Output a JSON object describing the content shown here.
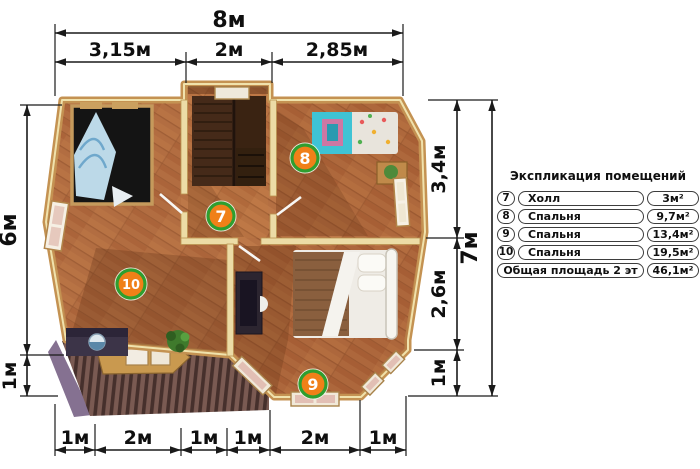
{
  "dims": {
    "top_total": "8м",
    "top_segments": [
      "3,15м",
      "2м",
      "2,85м"
    ],
    "left_segments": [
      "6м",
      "1м"
    ],
    "right_segments": [
      "3,4м",
      "2,6м",
      "1м"
    ],
    "right_total": "7м",
    "bottom_segments": [
      "1м",
      "2м",
      "1м",
      "1м",
      "2м",
      "1м"
    ]
  },
  "rooms": [
    {
      "num": "7",
      "name": "Холл",
      "area": "3м²"
    },
    {
      "num": "8",
      "name": "Спальня",
      "area": "9,7м²"
    },
    {
      "num": "9",
      "name": "Спальня",
      "area": "13,4м²"
    },
    {
      "num": "10",
      "name": "Спальня",
      "area": "19,5м²"
    }
  ],
  "legend": {
    "title": "Экспликация помещений",
    "total": {
      "name": "Общая площадь 2 эт",
      "area": "46,1м²"
    }
  },
  "colors": {
    "badge-fill": "#f08018",
    "badge-ring": "#2f9e2f",
    "floor-wood": "#b46f42",
    "wall-gold": "#c49252",
    "wall-cream": "#ecdca6",
    "roof-dark": "#46302c",
    "dim-line": "#1a1a1a"
  }
}
